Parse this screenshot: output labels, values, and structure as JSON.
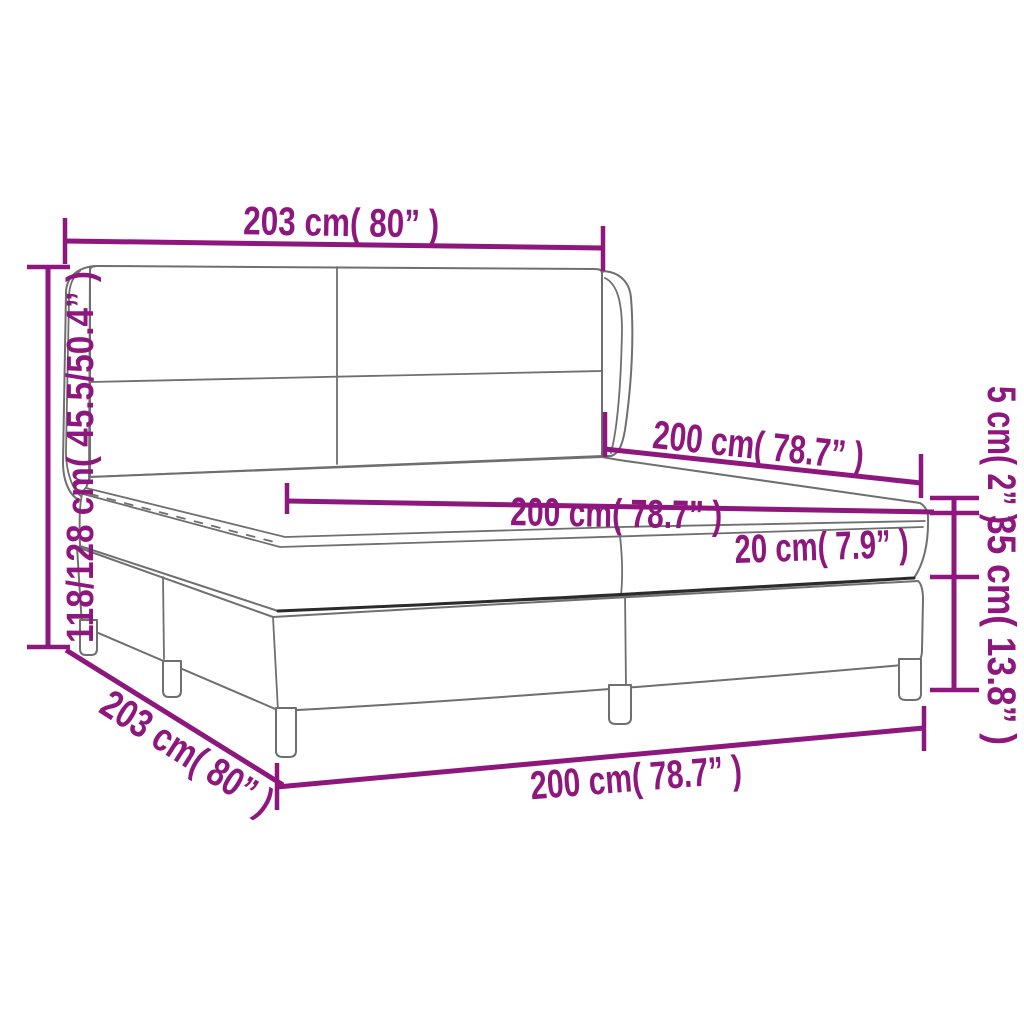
{
  "diagram": {
    "colors": {
      "dimension_accent": "#8E177E",
      "outline": "#6F6F6F",
      "outline_dark": "#2B2B2B",
      "background": "#FFFFFF"
    },
    "labels": {
      "headboard_width": "203 cm( 80” )",
      "headboard_height": "118/128 cm( 45.5/50.4” )",
      "bed_length": "200 cm( 78.7” )",
      "mattress_width": "200 cm( 78.7” )",
      "topper_thickness": "5 cm( 2” )",
      "mattress_thickness": "20 cm( 7.9” )",
      "base_height": "35 cm( 13.8” )",
      "base_length": "203 cm( 80” )",
      "base_width": "200 cm( 78.7” )"
    }
  }
}
